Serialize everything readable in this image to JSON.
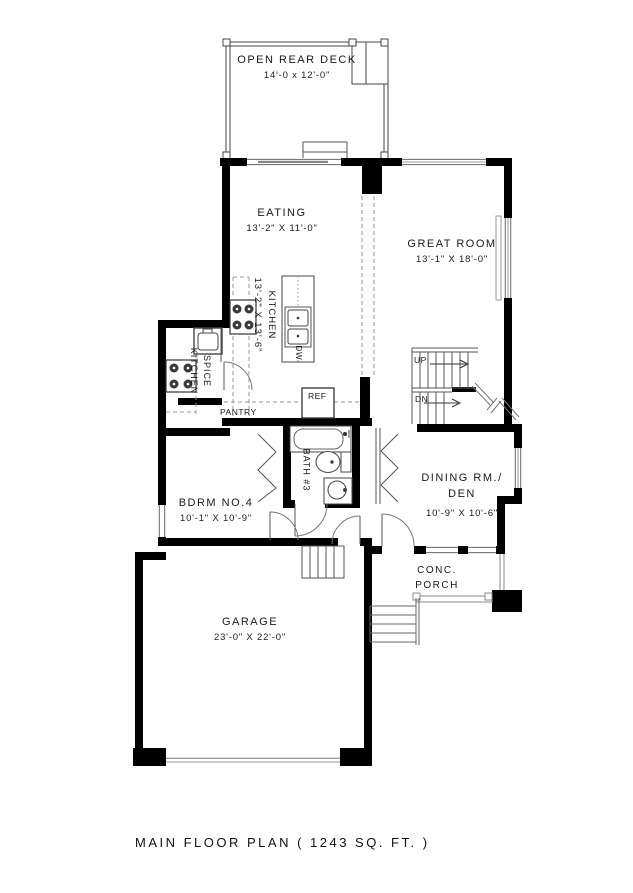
{
  "title": "MAIN FLOOR PLAN ( 1243 SQ. FT. )",
  "rooms": {
    "deck": {
      "name": "OPEN REAR DECK",
      "dims": "14'-0 x 12'-0\""
    },
    "eating": {
      "name": "EATING",
      "dims": "13'-2\" X 11'-0\""
    },
    "great_room": {
      "name": "GREAT ROOM",
      "dims": "13'-1\" X 18'-0\""
    },
    "kitchen": {
      "name": "KITCHEN",
      "dims": "13'-2\" X 13'-6\""
    },
    "spice_kitchen": {
      "line1": "SPICE",
      "line2": "KITCHEN"
    },
    "pantry": {
      "name": "PANTRY"
    },
    "bath": {
      "name": "BATH #3"
    },
    "bedroom": {
      "name": "BDRM NO.4",
      "dims": "10'-1\" X 10'-9\""
    },
    "dining": {
      "line1": "DINING RM./",
      "line2": "DEN",
      "dims": "10'-9\" X 10'-6\""
    },
    "porch": {
      "line1": "CONC.",
      "line2": "PORCH"
    },
    "garage": {
      "name": "GARAGE",
      "dims": "23'-0\" X 22'-0\""
    }
  },
  "fixtures": {
    "ref": "REF",
    "dw": "DW"
  },
  "stairs": {
    "up": "UP",
    "dn": "DN"
  },
  "colors": {
    "wall": "#000000",
    "thin_line": "#555555",
    "dashed_line": "#999999",
    "background": "#ffffff"
  }
}
